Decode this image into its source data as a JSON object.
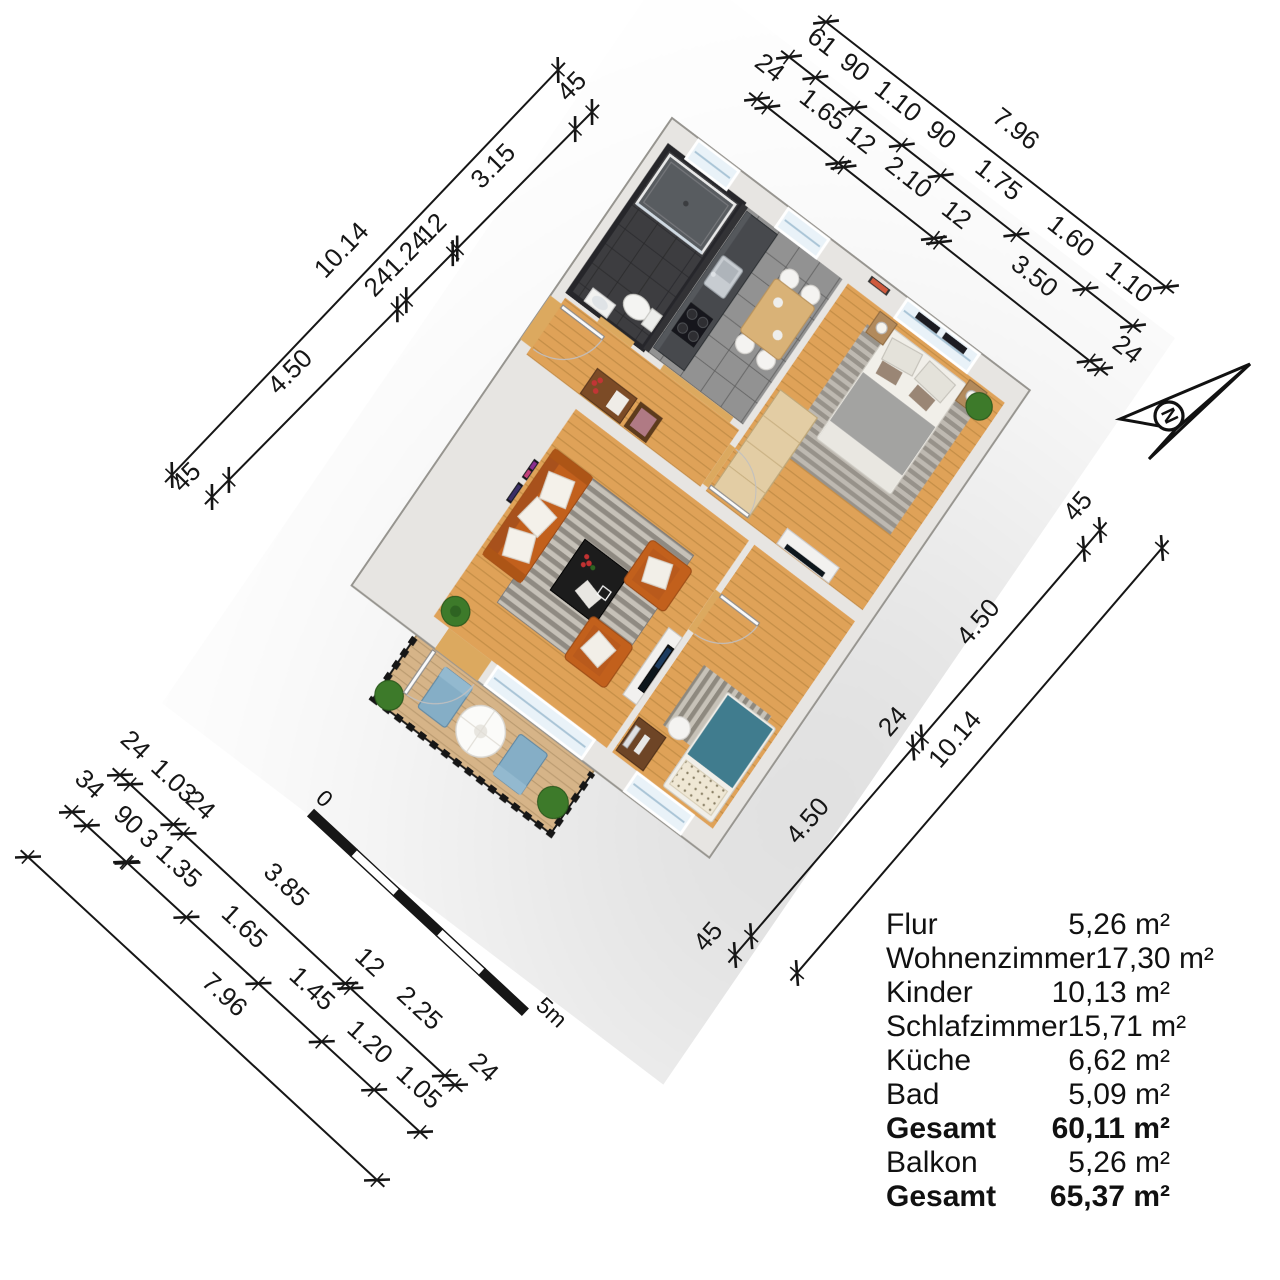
{
  "dimensions": {
    "chains": [
      {
        "id": "nw-outer",
        "segments": [
          {
            "label": "10.14",
            "len": 10.14
          }
        ]
      },
      {
        "id": "nw-inner",
        "segments": [
          {
            "label": "45",
            "len": 0.45
          },
          {
            "label": "4.50",
            "len": 4.5
          },
          {
            "label": "24",
            "len": 0.24
          },
          {
            "label": "1.24",
            "len": 1.24
          },
          {
            "label": "12",
            "len": 0.12
          },
          {
            "label": "3.15",
            "len": 3.15
          },
          {
            "label": "45",
            "len": 0.45
          }
        ]
      },
      {
        "id": "ne-outer",
        "segments": [
          {
            "label": "7.96",
            "len": 7.96
          }
        ]
      },
      {
        "id": "ne-mid",
        "segments": [
          {
            "label": "61",
            "len": 0.61
          },
          {
            "label": "90",
            "len": 0.9
          },
          {
            "label": "1.10",
            "len": 1.1
          },
          {
            "label": "90",
            "len": 0.9
          },
          {
            "label": "1.75",
            "len": 1.75
          },
          {
            "label": "1.60",
            "len": 1.6
          },
          {
            "label": "1.10",
            "len": 1.1
          }
        ]
      },
      {
        "id": "ne-inner",
        "segments": [
          {
            "label": "24",
            "len": 0.24
          },
          {
            "label": "1.65",
            "len": 1.65
          },
          {
            "label": "12",
            "len": 0.12
          },
          {
            "label": "2.10",
            "len": 2.1
          },
          {
            "label": "12",
            "len": 0.12
          },
          {
            "label": "3.50",
            "len": 3.5
          },
          {
            "label": "24",
            "len": 0.24
          }
        ]
      },
      {
        "id": "se-inner",
        "segments": [
          {
            "label": "45",
            "len": 0.45
          },
          {
            "label": "4.50",
            "len": 4.5
          },
          {
            "label": "24",
            "len": 0.24
          },
          {
            "label": "4.50",
            "len": 4.5
          },
          {
            "label": "45",
            "len": 0.45
          }
        ]
      },
      {
        "id": "se-outer",
        "segments": [
          {
            "label": "10.14",
            "len": 10.14
          }
        ]
      },
      {
        "id": "sw-inner",
        "segments": [
          {
            "label": "24",
            "len": 0.24
          },
          {
            "label": "1.03",
            "len": 1.03
          },
          {
            "label": "24",
            "len": 0.24
          },
          {
            "label": "3.85",
            "len": 3.85
          },
          {
            "label": "12",
            "len": 0.12
          },
          {
            "label": "2.25",
            "len": 2.25
          },
          {
            "label": "24",
            "len": 0.24
          }
        ]
      },
      {
        "id": "sw-mid",
        "segments": [
          {
            "label": "34",
            "len": 0.34
          },
          {
            "label": "90",
            "len": 0.9
          },
          {
            "label": "3",
            "len": 0.03
          },
          {
            "label": "1.35",
            "len": 1.35
          },
          {
            "label": "1.65",
            "len": 1.65
          },
          {
            "label": "1.45",
            "len": 1.45
          },
          {
            "label": "1.20",
            "len": 1.2
          },
          {
            "label": "1.05",
            "len": 1.05
          }
        ]
      },
      {
        "id": "sw-outer",
        "segments": [
          {
            "label": "7.96",
            "len": 7.96
          }
        ]
      }
    ]
  },
  "scale_bar": {
    "start_label": "0",
    "end_label": "5m"
  },
  "compass": {
    "label": "N"
  },
  "area_table": {
    "rows": [
      {
        "label": "Flur",
        "value": "5,26 m²",
        "bold": false
      },
      {
        "label": "Wohnenzimmer",
        "value": "17,30 m²",
        "bold": false
      },
      {
        "label": "Kinder",
        "value": "10,13 m²",
        "bold": false
      },
      {
        "label": "Schlafzimmer",
        "value": "15,71 m²",
        "bold": false
      },
      {
        "label": "Küche",
        "value": "6,62 m²",
        "bold": false
      },
      {
        "label": "Bad",
        "value": "5,09 m²",
        "bold": false
      },
      {
        "label": "Gesamt",
        "value": "60,11 m²",
        "bold": true
      },
      {
        "label": "Balkon",
        "value": "5,26 m²",
        "bold": false
      },
      {
        "label": "Gesamt",
        "value": "65,37 m²",
        "bold": true
      }
    ]
  },
  "colors": {
    "wood": "#dfa258",
    "wood_balcony": "#d6b488",
    "tile_bath": "#3d3d40",
    "tile_kitchen": "#929292",
    "wall": "#e7e5e2",
    "sofa_orange": "#c2601d",
    "kids_teal": "#3f7b8e",
    "lounger_blue": "#85aec6",
    "plant_green": "#3c7a2a",
    "ink": "#161616"
  }
}
